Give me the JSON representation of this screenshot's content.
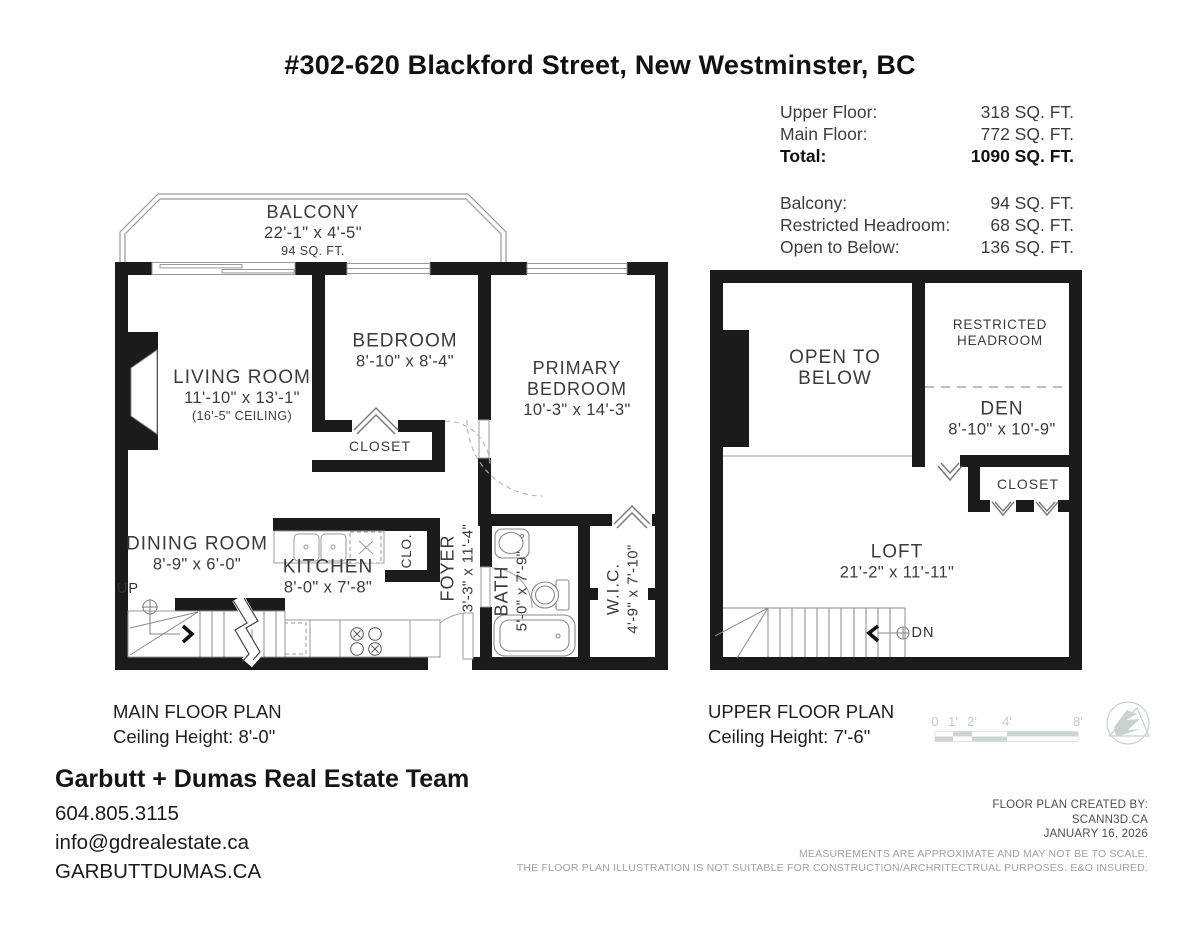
{
  "title": "#302-620 Blackford Street, New Westminster, BC",
  "areas": {
    "rows": [
      {
        "label": "Upper Floor:",
        "value": "318 SQ. FT."
      },
      {
        "label": "Main Floor:",
        "value": "772 SQ. FT."
      },
      {
        "label": "Total:",
        "value": "1090 SQ. FT."
      },
      {
        "label": "Balcony:",
        "value": "94 SQ. FT."
      },
      {
        "label": "Restricted Headroom:",
        "value": "68 SQ. FT."
      },
      {
        "label": "Open to Below:",
        "value": "136 SQ. FT."
      }
    ]
  },
  "main_floor": {
    "balcony": {
      "name": "BALCONY",
      "dims": "22'-1\" x 4'-5\"",
      "area": "94 SQ. FT."
    },
    "living_room": {
      "name": "LIVING ROOM",
      "dims": "11'-10\" x 13'-1\"",
      "note": "(16'-5\" CEILING)"
    },
    "bedroom": {
      "name": "BEDROOM",
      "dims": "8'-10\" x 8'-4\""
    },
    "primary_bedroom": {
      "name_line1": "PRIMARY",
      "name_line2": "BEDROOM",
      "dims": "10'-3\" x 14'-3\""
    },
    "closet": "CLOSET",
    "dining_room": {
      "name": "DINING ROOM",
      "dims": "8'-9\" x 6'-0\""
    },
    "kitchen": {
      "name": "KITCHEN",
      "dims": "8'-0\" x 7'-8\""
    },
    "clo": "CLO.",
    "foyer": {
      "name": "FOYER",
      "dims": "3'-3\" x 11'-4\""
    },
    "bath": {
      "name": "BATH",
      "dims": "5'-0\" x 7'-9\""
    },
    "wic": {
      "name": "W.I.C.",
      "dims": "4'-9\" x 7'-10\""
    },
    "up": "UP",
    "caption_line1": "MAIN FLOOR PLAN",
    "caption_line2": "Ceiling Height: 8'-0\""
  },
  "upper_floor": {
    "open_to_below_line1": "OPEN TO",
    "open_to_below_line2": "BELOW",
    "restricted_line1": "RESTRICTED",
    "restricted_line2": "HEADROOM",
    "den": {
      "name": "DEN",
      "dims": "8'-10\" x 10'-9\""
    },
    "closet": "CLOSET",
    "loft": {
      "name": "LOFT",
      "dims": "21'-2\" x 11'-11\""
    },
    "dn": "DN",
    "caption_line1": "UPPER FLOOR PLAN",
    "caption_line2": "Ceiling Height: 7'-6\""
  },
  "scale_bar": {
    "labels": [
      "0",
      "1'",
      "2'",
      "4'",
      "8'"
    ]
  },
  "footer": {
    "team": "Garbutt + Dumas Real Estate Team",
    "phone": "604.805.3115",
    "email": "info@gdrealestate.ca",
    "website": "GARBUTTDUMAS.CA",
    "credit_line1": "FLOOR PLAN CREATED BY:",
    "credit_line2": "SCANN3D.CA",
    "credit_line3": "JANUARY 16, 2026",
    "disclaimer_line1": "MEASUREMENTS ARE APPROXIMATE AND MAY NOT BE TO SCALE.",
    "disclaimer_line2": "THE FLOOR PLAN ILLUSTRATION IS NOT SUITABLE FOR CONSTRUCTION/ARCHRITECTRUAL PURPOSES. E&O INSURED."
  },
  "colors": {
    "wall": "#1b1b1b",
    "thin_line": "#999999",
    "room_text": "#3b3b3b",
    "muted_text": "#9aa3a3",
    "scale_gray": "#c6cece"
  }
}
